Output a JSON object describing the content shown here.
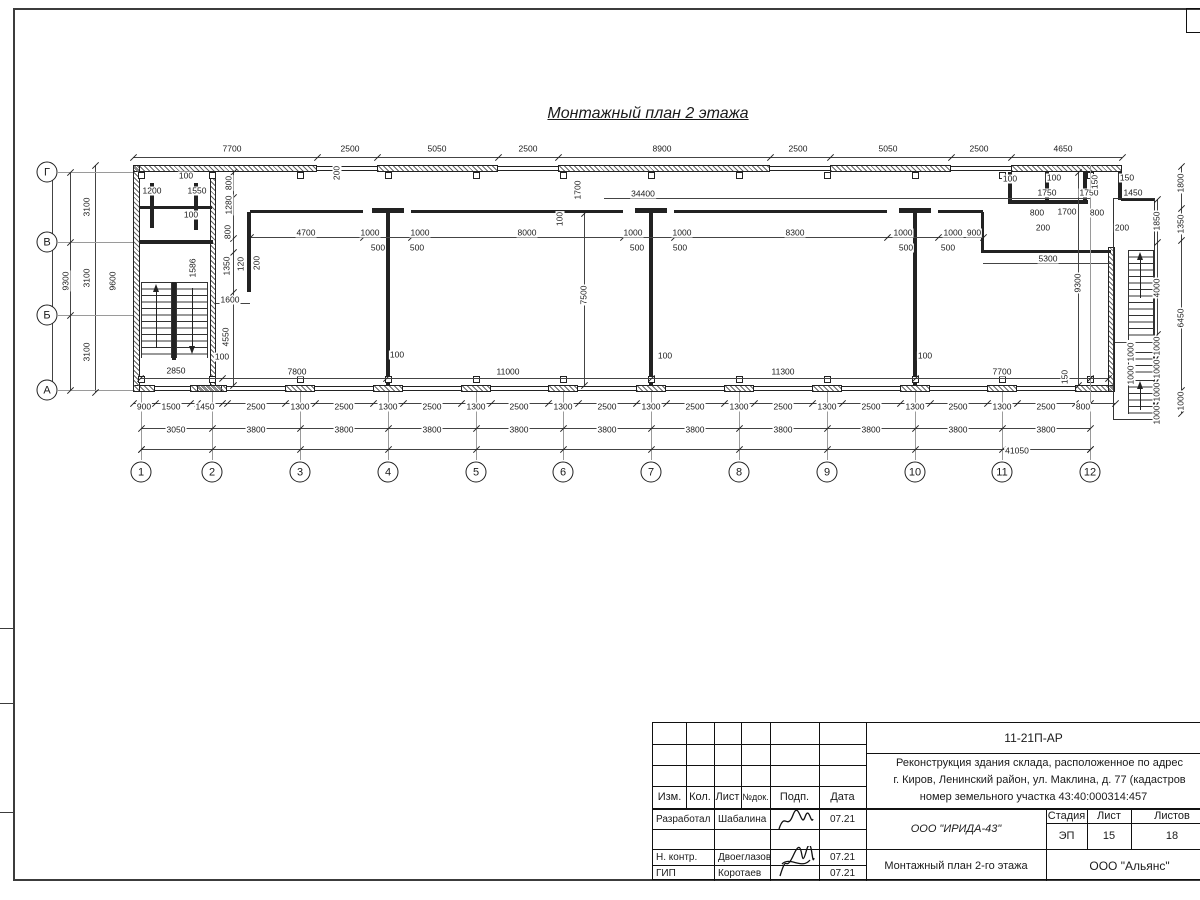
{
  "title": "Монтажный план 2 этажа",
  "grid": {
    "cols": [
      {
        "n": "1",
        "x": 141
      },
      {
        "n": "2",
        "x": 212
      },
      {
        "n": "3",
        "x": 300
      },
      {
        "n": "4",
        "x": 388
      },
      {
        "n": "5",
        "x": 476
      },
      {
        "n": "6",
        "x": 563
      },
      {
        "n": "7",
        "x": 651
      },
      {
        "n": "8",
        "x": 739
      },
      {
        "n": "9",
        "x": 827
      },
      {
        "n": "10",
        "x": 915
      },
      {
        "n": "11",
        "x": 1002
      },
      {
        "n": "12",
        "x": 1090
      }
    ],
    "rows": [
      {
        "n": "Г",
        "y": 172
      },
      {
        "n": "В",
        "y": 242
      },
      {
        "n": "Б",
        "y": 315
      },
      {
        "n": "А",
        "y": 390
      }
    ]
  },
  "dim_labels": [
    {
      "t": "7700",
      "x": 232,
      "y": 149
    },
    {
      "t": "2500",
      "x": 350,
      "y": 149
    },
    {
      "t": "5050",
      "x": 437,
      "y": 149
    },
    {
      "t": "2500",
      "x": 528,
      "y": 149
    },
    {
      "t": "8900",
      "x": 662,
      "y": 149
    },
    {
      "t": "2500",
      "x": 798,
      "y": 149
    },
    {
      "t": "5050",
      "x": 888,
      "y": 149
    },
    {
      "t": "2500",
      "x": 979,
      "y": 149
    },
    {
      "t": "4650",
      "x": 1063,
      "y": 149
    },
    {
      "t": "200",
      "x": 337,
      "y": 173,
      "r": 90
    },
    {
      "t": "100",
      "x": 186,
      "y": 176
    },
    {
      "t": "1200",
      "x": 152,
      "y": 191
    },
    {
      "t": "1550",
      "x": 197,
      "y": 191
    },
    {
      "t": "100",
      "x": 191,
      "y": 215
    },
    {
      "t": "800",
      "x": 229,
      "y": 183,
      "r": 90
    },
    {
      "t": "1280",
      "x": 229,
      "y": 205,
      "r": 90
    },
    {
      "t": "800",
      "x": 228,
      "y": 232,
      "r": 90
    },
    {
      "t": "1350",
      "x": 227,
      "y": 266,
      "r": 90
    },
    {
      "t": "120",
      "x": 241,
      "y": 264,
      "r": 90
    },
    {
      "t": "200",
      "x": 257,
      "y": 263,
      "r": 90
    },
    {
      "t": "1586",
      "x": 193,
      "y": 268,
      "r": 90
    },
    {
      "t": "1600",
      "x": 230,
      "y": 300
    },
    {
      "t": "4550",
      "x": 226,
      "y": 337,
      "r": 90
    },
    {
      "t": "100",
      "x": 222,
      "y": 357
    },
    {
      "t": "2850",
      "x": 176,
      "y": 371
    },
    {
      "t": "1700",
      "x": 578,
      "y": 190,
      "r": 90
    },
    {
      "t": "34400",
      "x": 643,
      "y": 194
    },
    {
      "t": "100",
      "x": 560,
      "y": 219,
      "r": 90
    },
    {
      "t": "7500",
      "x": 584,
      "y": 295,
      "r": 90
    },
    {
      "t": "4700",
      "x": 306,
      "y": 233
    },
    {
      "t": "1000",
      "x": 370,
      "y": 233
    },
    {
      "t": "500",
      "x": 378,
      "y": 248
    },
    {
      "t": "1000",
      "x": 420,
      "y": 233
    },
    {
      "t": "500",
      "x": 417,
      "y": 248
    },
    {
      "t": "8000",
      "x": 527,
      "y": 233
    },
    {
      "t": "1000",
      "x": 633,
      "y": 233
    },
    {
      "t": "500",
      "x": 637,
      "y": 248
    },
    {
      "t": "1000",
      "x": 682,
      "y": 233
    },
    {
      "t": "500",
      "x": 680,
      "y": 248
    },
    {
      "t": "8300",
      "x": 795,
      "y": 233
    },
    {
      "t": "1000",
      "x": 903,
      "y": 233
    },
    {
      "t": "500",
      "x": 906,
      "y": 248
    },
    {
      "t": "1000",
      "x": 953,
      "y": 233
    },
    {
      "t": "500",
      "x": 948,
      "y": 248
    },
    {
      "t": "900",
      "x": 974,
      "y": 233
    },
    {
      "t": "5300",
      "x": 1048,
      "y": 259
    },
    {
      "t": "9300",
      "x": 1078,
      "y": 283,
      "r": 90
    },
    {
      "t": "100",
      "x": 1010,
      "y": 179
    },
    {
      "t": "100",
      "x": 1054,
      "y": 178
    },
    {
      "t": "1750",
      "x": 1047,
      "y": 193
    },
    {
      "t": "1750",
      "x": 1089,
      "y": 193
    },
    {
      "t": "150",
      "x": 1095,
      "y": 182,
      "r": 90
    },
    {
      "t": "150",
      "x": 1127,
      "y": 178
    },
    {
      "t": "1450",
      "x": 1133,
      "y": 193
    },
    {
      "t": "800",
      "x": 1037,
      "y": 213
    },
    {
      "t": "1700",
      "x": 1067,
      "y": 212
    },
    {
      "t": "800",
      "x": 1097,
      "y": 213
    },
    {
      "t": "200",
      "x": 1043,
      "y": 228
    },
    {
      "t": "200",
      "x": 1122,
      "y": 228
    },
    {
      "t": "1800",
      "x": 1181,
      "y": 183,
      "r": 90
    },
    {
      "t": "1350",
      "x": 1181,
      "y": 224,
      "r": 90
    },
    {
      "t": "6450",
      "x": 1181,
      "y": 318,
      "r": 90
    },
    {
      "t": "1000",
      "x": 1181,
      "y": 401,
      "r": 90
    },
    {
      "t": "1850",
      "x": 1157,
      "y": 221,
      "r": 90
    },
    {
      "t": "4000",
      "x": 1157,
      "y": 288,
      "r": 90
    },
    {
      "t": "1000",
      "x": 1157,
      "y": 346,
      "r": 90
    },
    {
      "t": "1000",
      "x": 1157,
      "y": 369,
      "r": 90
    },
    {
      "t": "1000",
      "x": 1157,
      "y": 392,
      "r": 90
    },
    {
      "t": "1000",
      "x": 1157,
      "y": 415,
      "r": 90
    },
    {
      "t": "1000",
      "x": 1131,
      "y": 352,
      "r": 90
    },
    {
      "t": "1000",
      "x": 1131,
      "y": 375,
      "r": 90
    },
    {
      "t": "100",
      "x": 397,
      "y": 355
    },
    {
      "t": "100",
      "x": 665,
      "y": 356
    },
    {
      "t": "100",
      "x": 925,
      "y": 356
    },
    {
      "t": "7800",
      "x": 297,
      "y": 372
    },
    {
      "t": "11000",
      "x": 508,
      "y": 372
    },
    {
      "t": "11300",
      "x": 783,
      "y": 372
    },
    {
      "t": "7700",
      "x": 1002,
      "y": 372
    },
    {
      "t": "150",
      "x": 1065,
      "y": 377,
      "r": 90
    },
    {
      "t": "900",
      "x": 144,
      "y": 407
    },
    {
      "t": "1500",
      "x": 171,
      "y": 407
    },
    {
      "t": "1450",
      "x": 205,
      "y": 407
    },
    {
      "t": "2500",
      "x": 256,
      "y": 407
    },
    {
      "t": "1300",
      "x": 300,
      "y": 407
    },
    {
      "t": "2500",
      "x": 344,
      "y": 407
    },
    {
      "t": "1300",
      "x": 388,
      "y": 407
    },
    {
      "t": "2500",
      "x": 432,
      "y": 407
    },
    {
      "t": "1300",
      "x": 476,
      "y": 407
    },
    {
      "t": "2500",
      "x": 519,
      "y": 407
    },
    {
      "t": "1300",
      "x": 563,
      "y": 407
    },
    {
      "t": "2500",
      "x": 607,
      "y": 407
    },
    {
      "t": "1300",
      "x": 651,
      "y": 407
    },
    {
      "t": "2500",
      "x": 695,
      "y": 407
    },
    {
      "t": "1300",
      "x": 739,
      "y": 407
    },
    {
      "t": "2500",
      "x": 783,
      "y": 407
    },
    {
      "t": "1300",
      "x": 827,
      "y": 407
    },
    {
      "t": "2500",
      "x": 871,
      "y": 407
    },
    {
      "t": "1300",
      "x": 915,
      "y": 407
    },
    {
      "t": "2500",
      "x": 958,
      "y": 407
    },
    {
      "t": "1300",
      "x": 1002,
      "y": 407
    },
    {
      "t": "2500",
      "x": 1046,
      "y": 407
    },
    {
      "t": "800",
      "x": 1083,
      "y": 407
    },
    {
      "t": "3050",
      "x": 176,
      "y": 430
    },
    {
      "t": "3800",
      "x": 256,
      "y": 430
    },
    {
      "t": "3800",
      "x": 344,
      "y": 430
    },
    {
      "t": "3800",
      "x": 432,
      "y": 430
    },
    {
      "t": "3800",
      "x": 519,
      "y": 430
    },
    {
      "t": "3800",
      "x": 607,
      "y": 430
    },
    {
      "t": "3800",
      "x": 695,
      "y": 430
    },
    {
      "t": "3800",
      "x": 783,
      "y": 430
    },
    {
      "t": "3800",
      "x": 871,
      "y": 430
    },
    {
      "t": "3800",
      "x": 958,
      "y": 430
    },
    {
      "t": "3800",
      "x": 1046,
      "y": 430
    },
    {
      "t": "41050",
      "x": 1017,
      "y": 451
    },
    {
      "t": "3100",
      "x": 87,
      "y": 207,
      "r": 90
    },
    {
      "t": "3100",
      "x": 87,
      "y": 278,
      "r": 90
    },
    {
      "t": "3100",
      "x": 87,
      "y": 352,
      "r": 90
    },
    {
      "t": "9300",
      "x": 66,
      "y": 281,
      "r": 90
    },
    {
      "t": "9600",
      "x": 113,
      "y": 281,
      "r": 90
    }
  ],
  "title_block": {
    "doc_code": "11-21П-АР",
    "desc1": "Реконструкция здания склада, расположенное по адрес",
    "desc2": "г. Киров, Ленинский район, ул. Маклина, д. 77 (кадастров",
    "desc3": "номер земельного участка 43:40:000314:457",
    "cols": [
      "Изм.",
      "Кол.",
      "Лист",
      "№док.",
      "Подп.",
      "Дата"
    ],
    "row1": {
      "role": "Разработал",
      "name": "Шабалина",
      "date": "07.21"
    },
    "row2": {
      "role": "Н. контр.",
      "name": "Двоеглазов",
      "date": "07.21"
    },
    "row3": {
      "role": "ГИП",
      "name": "Коротаев",
      "date": "07.21"
    },
    "org1": "ООО \"ИРИДА-43\"",
    "drawing_name": "Монтажный план 2-го этажа",
    "stage_label": "Стадия",
    "sheet_label": "Лист",
    "sheets_label": "Листов",
    "stage": "ЭП",
    "sheet_no": "15",
    "sheets_total": "18",
    "org2": "ООО \"Альянс\""
  }
}
